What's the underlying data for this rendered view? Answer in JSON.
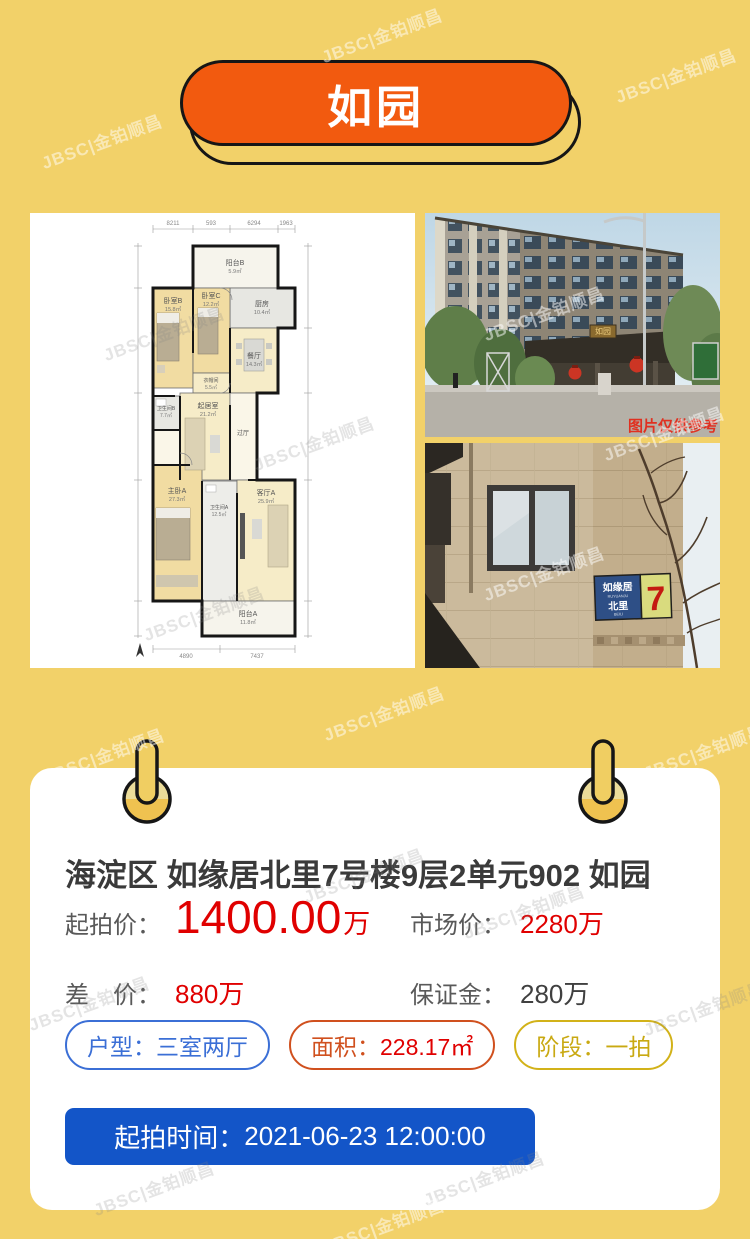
{
  "watermark": {
    "text": "JBSC|金铂顺昌"
  },
  "header": {
    "title": "如园"
  },
  "photos": {
    "floorplan": {
      "dims_top": [
        "8211",
        "593",
        "6294",
        "1963"
      ],
      "dims_bottom": [
        "4890",
        "7437"
      ],
      "rooms": {
        "balcony_b": {
          "name": "阳台B",
          "area": "5.9㎡"
        },
        "kitchen": {
          "name": "厨房",
          "area": "10.4㎡"
        },
        "bedroom_b": {
          "name": "卧室B",
          "area": "15.8㎡"
        },
        "bedroom_c": {
          "name": "卧室C",
          "area": "12.2㎡"
        },
        "dining": {
          "name": "餐厅",
          "area": "14.3㎡"
        },
        "cloakroom": {
          "name": "衣帽间",
          "area": "5.5㎡"
        },
        "bath_b": {
          "name": "卫生间B",
          "area": "7.7㎡"
        },
        "living_b": {
          "name": "起居室",
          "area": "21.2㎡"
        },
        "hall": {
          "name": "过厅",
          "area": ""
        },
        "master_a": {
          "name": "主卧A",
          "area": "27.3㎡"
        },
        "bath_a": {
          "name": "卫生间A",
          "area": "12.5㎡"
        },
        "living_a": {
          "name": "客厅A",
          "area": "25.9㎡"
        },
        "balcony_a": {
          "name": "阳台A",
          "area": "11.8㎡"
        }
      }
    },
    "building": {
      "caption": "图片仅供参考",
      "plaque": "如园"
    },
    "facade": {
      "sign": {
        "line1": "如缘居",
        "line1_sub": "RUYUANJU",
        "line2": "北里",
        "line2_sub": "BEILI",
        "number": "7"
      }
    }
  },
  "card": {
    "title": "海淀区 如缘居北里7号楼9层2单元902 如园",
    "prices": {
      "starting": {
        "label": "起拍价：",
        "value": "1400.00",
        "unit": "万"
      },
      "market": {
        "label": "市场价：",
        "value": "2280万"
      },
      "diff": {
        "label": "差　价：",
        "value": "880万"
      },
      "deposit": {
        "label": "保证金：",
        "value": "280万"
      }
    },
    "tags": {
      "layout": {
        "label": "户型：",
        "value": "三室两厅"
      },
      "area": {
        "label": "面积：",
        "value": "228.17㎡"
      },
      "stage": {
        "label": "阶段：",
        "value": "一拍"
      }
    },
    "button": {
      "label": "起拍时间：",
      "value": "2021-06-23 12:00:00"
    }
  },
  "colors": {
    "background": "#F2D169",
    "header_pill_orange": "#F25A0F",
    "price_red": "#E00000",
    "label_gray": "#595959",
    "title_dark": "#3A3A3A",
    "button_blue": "#1355C8",
    "tag_blue": "#3B6FD6",
    "tag_orange": "#D0501E",
    "tag_gold": "#D2B219"
  }
}
